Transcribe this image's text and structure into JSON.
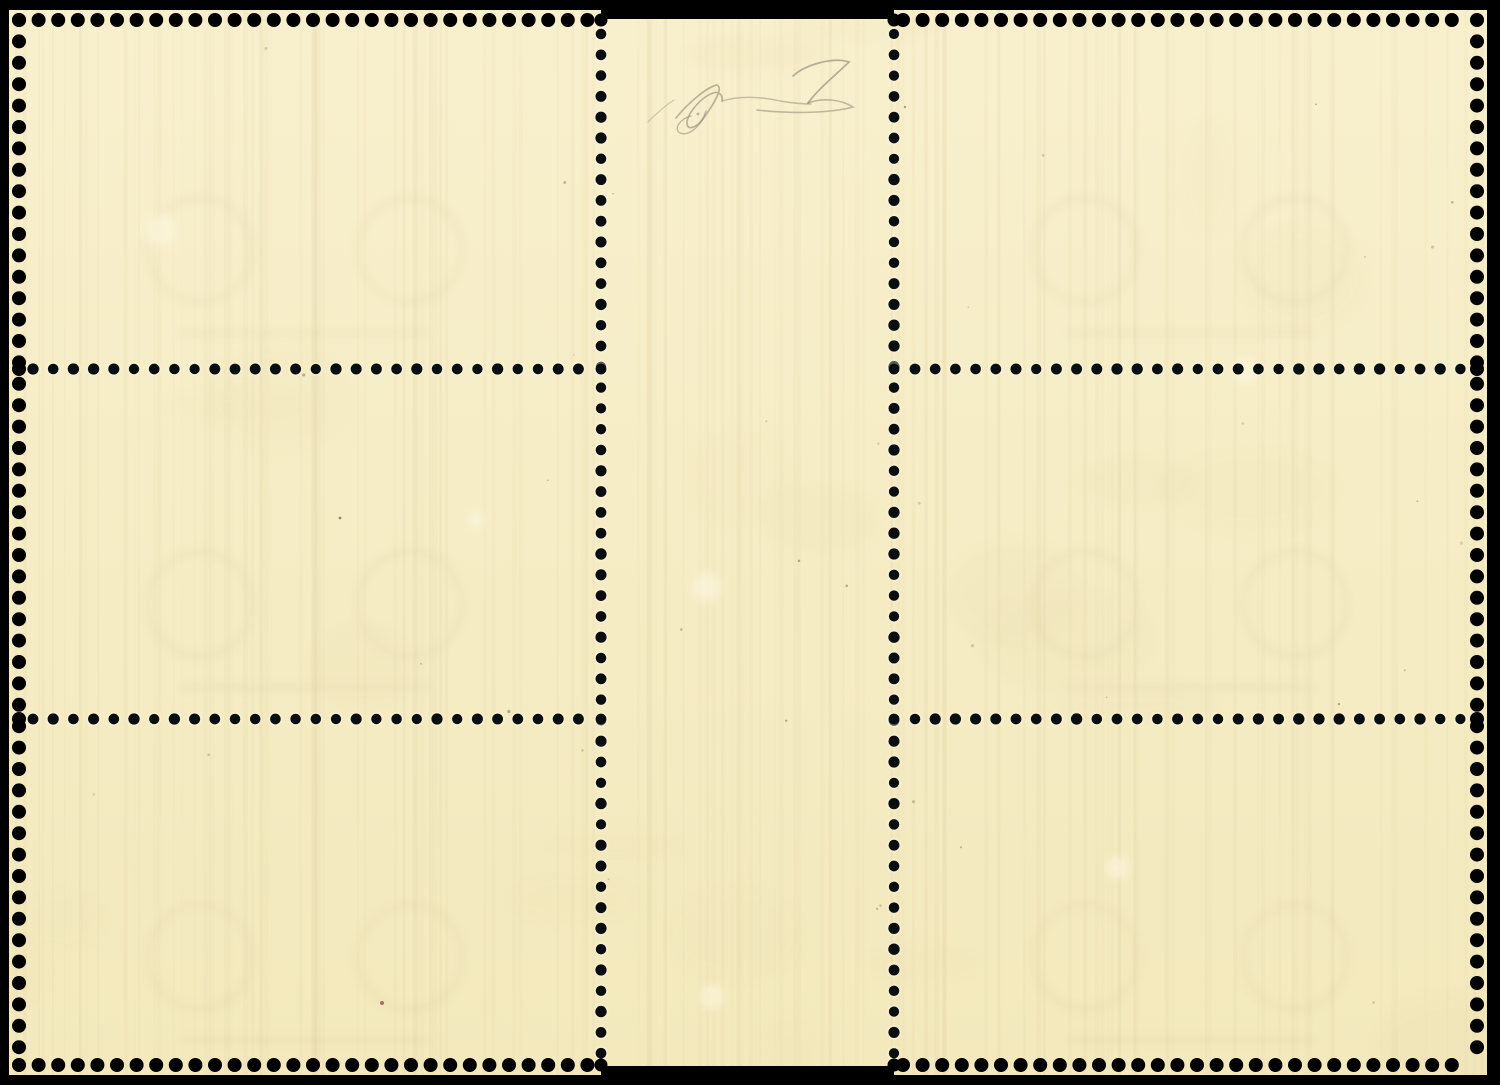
{
  "meta": {
    "title": "Reverse side of a mint stamp gutter block (two vertical strips of three) with a pencil expert signature on the gutter",
    "background": "#000000"
  },
  "scene": {
    "canvas": {
      "w": 1500,
      "h": 1085
    },
    "paper": {
      "fill_top": "#f8f0cd",
      "fill_bottom": "#f3e9bd",
      "blocks": [
        {
          "name": "left-stamp-block",
          "x": 9,
          "y": 10,
          "w": 592,
          "h": 1065
        },
        {
          "name": "gutter",
          "x": 601,
          "y": 19,
          "w": 293,
          "h": 1047
        },
        {
          "name": "right-stamp-block",
          "x": 894,
          "y": 10,
          "w": 593,
          "h": 1065
        }
      ]
    },
    "perforation": {
      "hole_color": "#0b0e11",
      "edge_hole_color": "#000000",
      "halo_color": "#fcf6e3",
      "edge_hole_r": 7,
      "inner_hole_r": 5.4,
      "notch_r": 6.5,
      "edge_top_y": 20,
      "edge_bottom_y": 1065,
      "edge_left_x": 19,
      "edge_right_x": 1477,
      "pitch_edge_h": 19.6,
      "pitch_edge_v": 21.4,
      "row_pitch": 20.2,
      "col_pitch": 20.8,
      "top_bottom_spans": [
        [
          19,
          591
        ],
        [
          903,
          1471
        ]
      ],
      "side_span": [
        20,
        1065
      ],
      "columns": {
        "x": [
          601,
          894
        ],
        "y_start": 34,
        "y_end": 1057
      },
      "rows": {
        "y": [
          369,
          719
        ],
        "left_span": [
          33,
          590
        ],
        "right_span": [
          915,
          1462
        ]
      }
    },
    "signature": {
      "color": "#8e8878",
      "strokes": [
        {
          "d": "M 648,122 C 656,114 666,105 674,100",
          "w": 1.2,
          "o": 0.4
        },
        {
          "d": "M 676,118 C 688,103 707,87 717,85 C 724,88 713,105 703,119 C 696,128 687,131 687,123 C 687,114 701,97 713,93 C 719,91 723,95 722,101",
          "w": 1.7,
          "o": 0.6
        },
        {
          "d": "M 706,111 C 702,124 690,137 680,133 C 673,129 680,119 691,116",
          "w": 1.4,
          "o": 0.55
        },
        {
          "d": "M 722,101 C 742,95 762,97 780,101 C 792,103 801,104 811,104",
          "w": 1.4,
          "o": 0.5
        },
        {
          "d": "M 793,76 C 806,64 834,57 849,62 C 840,71 818,89 808,103",
          "w": 1.8,
          "o": 0.62
        },
        {
          "d": "M 808,103 C 823,97 842,100 853,107 C 831,113 793,114 757,110",
          "w": 1.6,
          "o": 0.55
        }
      ],
      "dot": {
        "x": 698,
        "y": 114,
        "r": 1.4,
        "o": 0.6
      }
    },
    "ghosts": {
      "color": "#b99c6d",
      "opacity": 0.055,
      "motif_dx": 105,
      "motif_dy": 60,
      "motif_r": 52,
      "stroke_w": 9,
      "band_dy": 143,
      "band_half_w": 125,
      "band_h": 9,
      "stamps": [
        {
          "cx": 305,
          "cy": 190
        },
        {
          "cx": 305,
          "cy": 544
        },
        {
          "cx": 305,
          "cy": 897
        },
        {
          "cx": 1190,
          "cy": 190
        },
        {
          "cx": 1190,
          "cy": 544
        },
        {
          "cx": 1190,
          "cy": 897
        }
      ]
    },
    "flaws": {
      "light_color": "#fdf7e0",
      "light_spots": [
        {
          "x": 160,
          "y": 230,
          "r": 16
        },
        {
          "x": 707,
          "y": 587,
          "r": 14
        },
        {
          "x": 712,
          "y": 997,
          "r": 12
        },
        {
          "x": 1246,
          "y": 372,
          "r": 13
        },
        {
          "x": 476,
          "y": 520,
          "r": 9
        },
        {
          "x": 1118,
          "y": 868,
          "r": 11
        }
      ],
      "specks": [
        {
          "x": 382,
          "y": 1003,
          "r": 2.0,
          "c": "#8d4752",
          "o": 0.75
        },
        {
          "x": 340,
          "y": 518,
          "r": 1.4,
          "c": "#4a4a40",
          "o": 0.6
        },
        {
          "x": 905,
          "y": 107,
          "r": 1.2,
          "c": "#55503f",
          "o": 0.5
        }
      ],
      "speck_color": "#6b5c3e",
      "streak_color": "#cdb98a",
      "blotch_color": "#e6d6a6"
    },
    "random": {
      "seed": 42,
      "n_streaks": 150,
      "n_specks": 40,
      "n_blotches": 22
    }
  }
}
